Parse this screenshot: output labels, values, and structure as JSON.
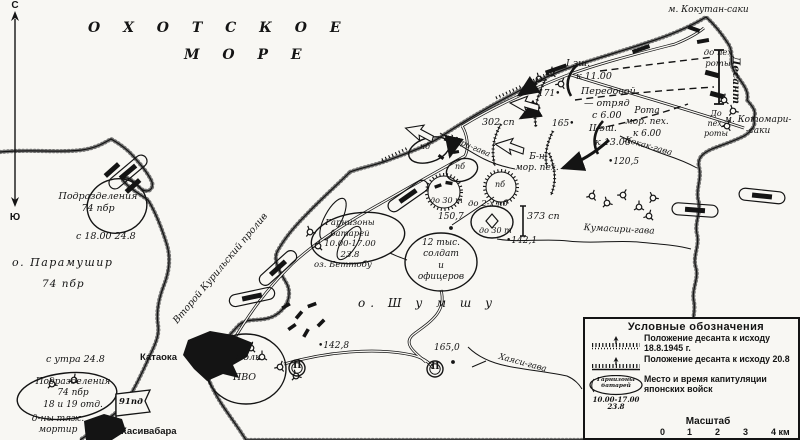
{
  "colors": {
    "ink": "#141414",
    "paper": "#f8f7f3"
  },
  "compass": {
    "north": "С",
    "south": "Ю"
  },
  "labels": [
    {
      "n": "sea-okhotsk-name-line1",
      "t": "О  Х  О  Т  С  К  О  Е",
      "x": 88,
      "y": 20,
      "fs": 14,
      "ls": 9,
      "b": 1
    },
    {
      "n": "sea-okhotsk-name-line2",
      "t": "М  О  Р  Е",
      "x": 184,
      "y": 47,
      "fs": 14,
      "ls": 9,
      "b": 1
    },
    {
      "n": "cape-kokutan-label",
      "t": "м. Кокутан-саки",
      "x": 668,
      "y": 5,
      "fs": 9
    },
    {
      "n": "cape-kotomari-label",
      "t": "м. Котомари-\n-саки",
      "x": 716,
      "y": 115,
      "fs": 9,
      "w": 84,
      "ta": "c"
    },
    {
      "n": "strait-second-kuril-label",
      "t": "Второй Курильский пролив",
      "x": 160,
      "y": 332,
      "fs": 9.5,
      "r": -50,
      "w": 175,
      "ta": "c"
    },
    {
      "n": "island-paramushir-label",
      "t": "о. Парамушир",
      "x": 12,
      "y": 256,
      "fs": 11,
      "ls": 1.5
    },
    {
      "n": "paramushir-74pbr-label",
      "t": "74 пбр",
      "x": 42,
      "y": 278,
      "fs": 10.5,
      "ls": 1
    },
    {
      "n": "island-shumshu-label",
      "t": "о.  Ш у м ш у",
      "x": 358,
      "y": 296,
      "fs": 12,
      "ls": 5
    },
    {
      "n": "river-kokak-label",
      "t": "Кокак-гава",
      "x": 626,
      "y": 135,
      "fs": 8.5,
      "r": 16
    },
    {
      "n": "river-kumasiri-label",
      "t": "Кумасири-гава",
      "x": 584,
      "y": 223,
      "fs": 9,
      "r": 3
    },
    {
      "n": "river-hayasi-label",
      "t": "Хаяси-гава",
      "x": 500,
      "y": 352,
      "fs": 8.5,
      "r": 15
    },
    {
      "n": "river-mori-label",
      "t": "Мори-гава",
      "x": 451,
      "y": 133,
      "fs": 8,
      "r": 23
    },
    {
      "n": "lake-bettobu-label",
      "t": "оз. Беттобу",
      "x": 314,
      "y": 260,
      "fs": 8.5
    },
    {
      "n": "town-kataoka-label",
      "t": "Катаока",
      "x": 140,
      "y": 352,
      "fs": 9.5,
      "b": 1,
      "sf": 1
    },
    {
      "n": "town-kasivabara-label",
      "t": "Касивабара",
      "x": 121,
      "y": 426,
      "fs": 9.5,
      "b": 1,
      "sf": 1
    },
    {
      "n": "units-74pbr-north-label",
      "t": "Подразделения\n74 пбр",
      "x": 48,
      "y": 191,
      "fs": 9.5,
      "w": 100,
      "ta": "c"
    },
    {
      "n": "time-from-1800-248-label",
      "t": "с 18.00 24.8",
      "x": 76,
      "y": 231,
      "fs": 9.5
    },
    {
      "n": "time-from-morning-248-label",
      "t": "с утра 24.8",
      "x": 46,
      "y": 354,
      "fs": 9.5
    },
    {
      "n": "units-74pbr-south-label",
      "t": "Подразделения\n74 пбр\n18 и 19 отд.",
      "x": 25,
      "y": 377,
      "fs": 9,
      "w": 96,
      "ta": "c"
    },
    {
      "n": "heavy-mortar-battalions-label",
      "t": "д-ны тяж.\nмортир",
      "x": 18,
      "y": 414,
      "fs": 9,
      "w": 80,
      "ta": "c"
    },
    {
      "n": "flag-91pd-label",
      "t": "91пд",
      "x": 119,
      "y": 397,
      "fs": 8.5,
      "b": 1
    },
    {
      "n": "regiment-302-label",
      "t": "302 сп",
      "x": 482,
      "y": 117,
      "fs": 9.5
    },
    {
      "n": "regiment-373-label",
      "t": "373 сп",
      "x": 527,
      "y": 211,
      "fs": 9.5
    },
    {
      "n": "pvo-regiment-label-line1",
      "t": "Полк",
      "x": 235,
      "y": 352,
      "fs": 9.5
    },
    {
      "n": "pvo-regiment-label-line2",
      "t": "ПВО",
      "x": 233,
      "y": 372,
      "fs": 9.5
    },
    {
      "n": "garrison-batteries-label",
      "t": "Гарнизоны\nбатарей\n10.00-17.00\n23.8",
      "x": 305,
      "y": 218,
      "fs": 8.5,
      "w": 90,
      "ta": "c"
    },
    {
      "n": "twelve-thousand-label",
      "t": "12 тыс.\nсолдат\nи\nофицеров",
      "x": 406,
      "y": 238,
      "fs": 9,
      "w": 70,
      "ta": "c"
    },
    {
      "n": "echelon1-label",
      "t": "I эш.",
      "x": 566,
      "y": 58,
      "fs": 9.5
    },
    {
      "n": "echelon1-time-label",
      "t": "к 11.00",
      "x": 576,
      "y": 71,
      "fs": 9.5
    },
    {
      "n": "echelon2-label",
      "t": "II эш.",
      "x": 589,
      "y": 123,
      "fs": 9.5
    },
    {
      "n": "echelon2-time-label",
      "t": "к 13.00",
      "x": 595,
      "y": 137,
      "fs": 9.5
    },
    {
      "n": "vanguard-label-line1",
      "t": "Передовой",
      "x": 581,
      "y": 86,
      "fs": 9.5
    },
    {
      "n": "vanguard-label-line2",
      "t": "— отряд",
      "x": 584,
      "y": 98,
      "fs": 9.5
    },
    {
      "n": "vanguard-label-line3",
      "t": "с 6.00",
      "x": 592,
      "y": 110,
      "fs": 9.5
    },
    {
      "n": "marine-company-label",
      "t": "Рота\nмор. пех.\nк 6.00",
      "x": 618,
      "y": 106,
      "fs": 9,
      "w": 58,
      "ta": "c"
    },
    {
      "n": "marine-battalion-label",
      "t": "Б-н\nмор. пех.",
      "x": 506,
      "y": 152,
      "fs": 9,
      "w": 62,
      "ta": "c"
    },
    {
      "n": "infantry-company-north-label",
      "t": "до пех\nроты",
      "x": 696,
      "y": 48,
      "fs": 8.5,
      "w": 44,
      "ta": "c"
    },
    {
      "n": "infantry-company-south-label",
      "t": "До\nпех.\nроты",
      "x": 698,
      "y": 109,
      "fs": 8,
      "w": 36,
      "ta": "c"
    },
    {
      "n": "desant-label",
      "t": "Десант",
      "x": 742,
      "y": 56,
      "fs": 10.5,
      "b": 1,
      "r": 90
    },
    {
      "n": "height-171-label",
      "t": "171•",
      "x": 538,
      "y": 89,
      "fs": 9
    },
    {
      "n": "height-165-label",
      "t": "165•",
      "x": 552,
      "y": 119,
      "fs": 9
    },
    {
      "n": "height-120-5-label",
      "t": "•120,5",
      "x": 608,
      "y": 157,
      "fs": 9
    },
    {
      "n": "height-150-7-label",
      "t": "150,7",
      "x": 438,
      "y": 212,
      "fs": 9
    },
    {
      "n": "height-142-1-label",
      "t": "•142,1",
      "x": 506,
      "y": 236,
      "fs": 9
    },
    {
      "n": "height-142-8-label",
      "t": "•142,8",
      "x": 318,
      "y": 341,
      "fs": 9
    },
    {
      "n": "height-165-0-label",
      "t": "165,0",
      "x": 434,
      "y": 343,
      "fs": 9
    },
    {
      "n": "pb-label-1",
      "t": "пб",
      "x": 420,
      "y": 142,
      "fs": 8
    },
    {
      "n": "pb-label-2",
      "t": "пб",
      "x": 455,
      "y": 162,
      "fs": 8
    },
    {
      "n": "pb-label-3",
      "t": "пб",
      "x": 495,
      "y": 180,
      "fs": 8
    },
    {
      "n": "tanks-30-label-1",
      "t": "до 30 т",
      "x": 430,
      "y": 196,
      "fs": 8
    },
    {
      "n": "tanks-30-label-2",
      "t": "до 30 т",
      "x": 479,
      "y": 226,
      "fs": 8
    },
    {
      "n": "infantry-2bn-label",
      "t": "до 2-х пб",
      "x": 468,
      "y": 199,
      "fs": 8.5
    },
    {
      "n": "circled-2-label-a",
      "t": "II",
      "x": 431,
      "y": 362,
      "fs": 9,
      "b": 1,
      "upr": 1
    },
    {
      "n": "circled-2-label-b",
      "t": "II",
      "x": 293,
      "y": 361,
      "fs": 9,
      "b": 1,
      "upr": 1
    }
  ],
  "legend": {
    "title": "Условные обозначения",
    "item1_label": "Положение десанта к исходу 18.8.1945 г.",
    "item2_label": "Положение десанта к исходу 20.8",
    "item3_label": "Место и время капитуляции японских войск",
    "item3_symbol": "Гарнизоны\nбатарей",
    "item3_symbol_time": "10.00-17.00\n23.8",
    "scale_title": "Масштаб",
    "scale_ticks": [
      "0",
      "1",
      "2",
      "3",
      "4 км"
    ]
  }
}
